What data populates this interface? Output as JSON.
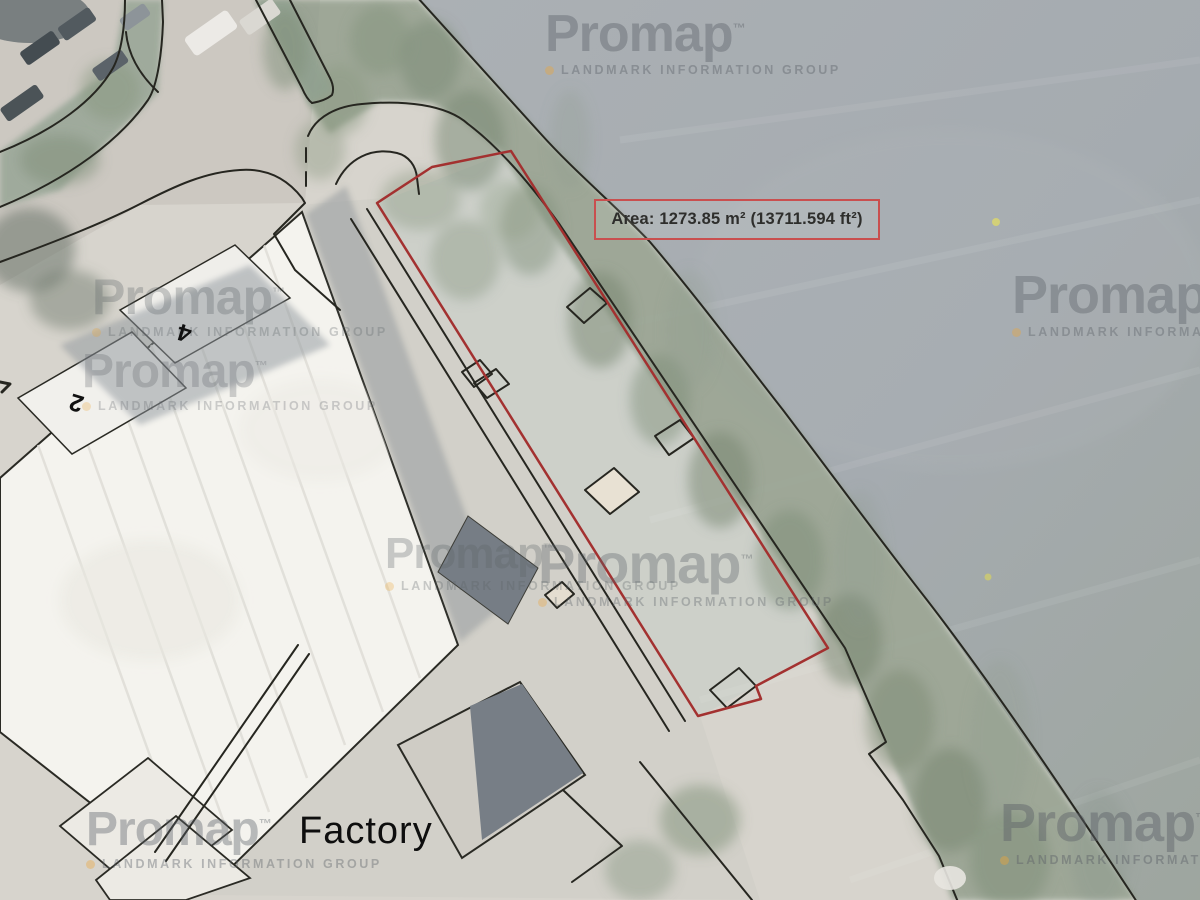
{
  "map": {
    "area_label": "Area: 1273.85 m² (13711.594 ft²)",
    "factory_label": "Factory",
    "building_numbers": {
      "four": "4",
      "two": "2"
    },
    "colors": {
      "measured_area_red": "#ab2f2e",
      "label_border_red": "#c94f4f",
      "line_black": "#26261f",
      "water_grey": "#a6acb1",
      "tree_green": "#8d9b88",
      "ground_light": "#d7d4cc",
      "factory_roof_white": "#f4f3ee",
      "shadow_grey": "#899097",
      "watermark_grey": "#5d6369",
      "watermark_orange": "#eda63a"
    }
  },
  "watermark": {
    "brand": "Promap",
    "trademark": "™",
    "subtitle": "LANDMARK INFORMATION GROUP"
  }
}
